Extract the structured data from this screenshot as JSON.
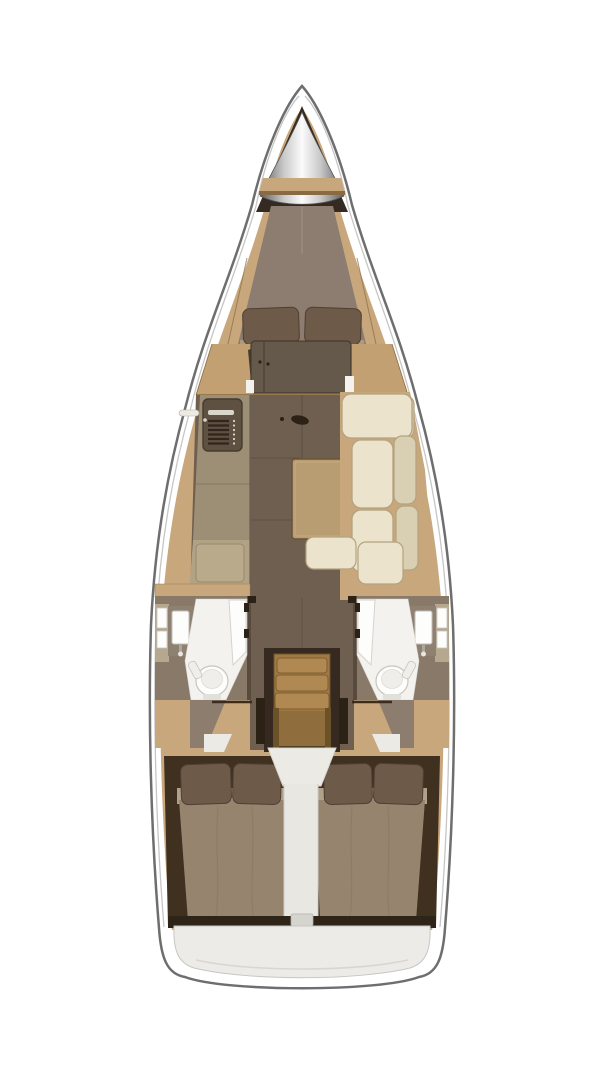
{
  "title": "Sailboat interior floor plan (top view)",
  "regions": {
    "anchor_locker": "bow anchor locker",
    "v_berth": "forward cabin V-berth",
    "wardrobe": "forward bulkhead wardrobe",
    "galley": "port galley with stove",
    "salon": "salon floor",
    "table": "salon table",
    "settee": "starboard L-settee",
    "head_port": "port head with toilet and sink",
    "head_starboard": "starboard head with toilet and sink",
    "companionway": "companionway stairs",
    "aft_cabin_port": "port aft double berth",
    "aft_cabin_starboard": "starboard aft double berth",
    "transom": "stern transom"
  },
  "colors": {
    "background": "#ffffff",
    "hull_fill": "#ffffff",
    "hull_outline": "#6e6e6e",
    "rim_line": "#c6c6c6",
    "wood_light": "#c8a77c",
    "wood_band": "#c2a072",
    "wood_seam": "#8a6a42",
    "bow_dark": "#342a21",
    "metal_dark": "#5f5f5f",
    "metal_mid": "#c8c8c8",
    "metal_light": "#fbfbfb",
    "mattress": "#8c7d70",
    "mattress_seam": "#9d8e80",
    "pillow": "#6d5a49",
    "pillow_dark": "#4e3f33",
    "sheet": "#ac9b83",
    "cabinet": "#65594c",
    "cabinet_dark": "#453a2f",
    "floor": "#6e5f51",
    "floor_seam": "#574a3e",
    "counter": "#9d8f76",
    "counter_light": "#b2a284",
    "fridge": "#b9aa8b",
    "stove": "#5f5142",
    "stove_grate": "#30261c",
    "stove_light": "#d9d5c9",
    "table": "#b89c72",
    "table_edge": "#6b5336",
    "cream": "#ebe3cb",
    "cream_dark": "#d9cfb2",
    "cream_edge": "#b3a37f",
    "head_wall": "#897969",
    "head_wall_dark": "#584a3d",
    "white_floor": "#f3f2ef",
    "fixture": "#fdfdfc",
    "fixture_edge": "#c6c4bd",
    "locker_strip": "#b5a88f",
    "stairs": "#a07a44",
    "stairs_tread": "#b08851",
    "stairs_side": "#6b5128",
    "stairs_shadow": "#352920",
    "stairs_lower": "#8f6d3c",
    "landing": "#eceae5",
    "column": "#e9e7e2",
    "aft_dark": "#40301f",
    "bed": "#96846e",
    "bed_sheet": "#b2a189",
    "dark_trim": "#2f2418",
    "hinge": "#2c2115",
    "transom": "#ecebe7",
    "transom_tab": "#d6d4cf",
    "step_white": "#eceae5",
    "wedge": "#8d7d6e"
  }
}
